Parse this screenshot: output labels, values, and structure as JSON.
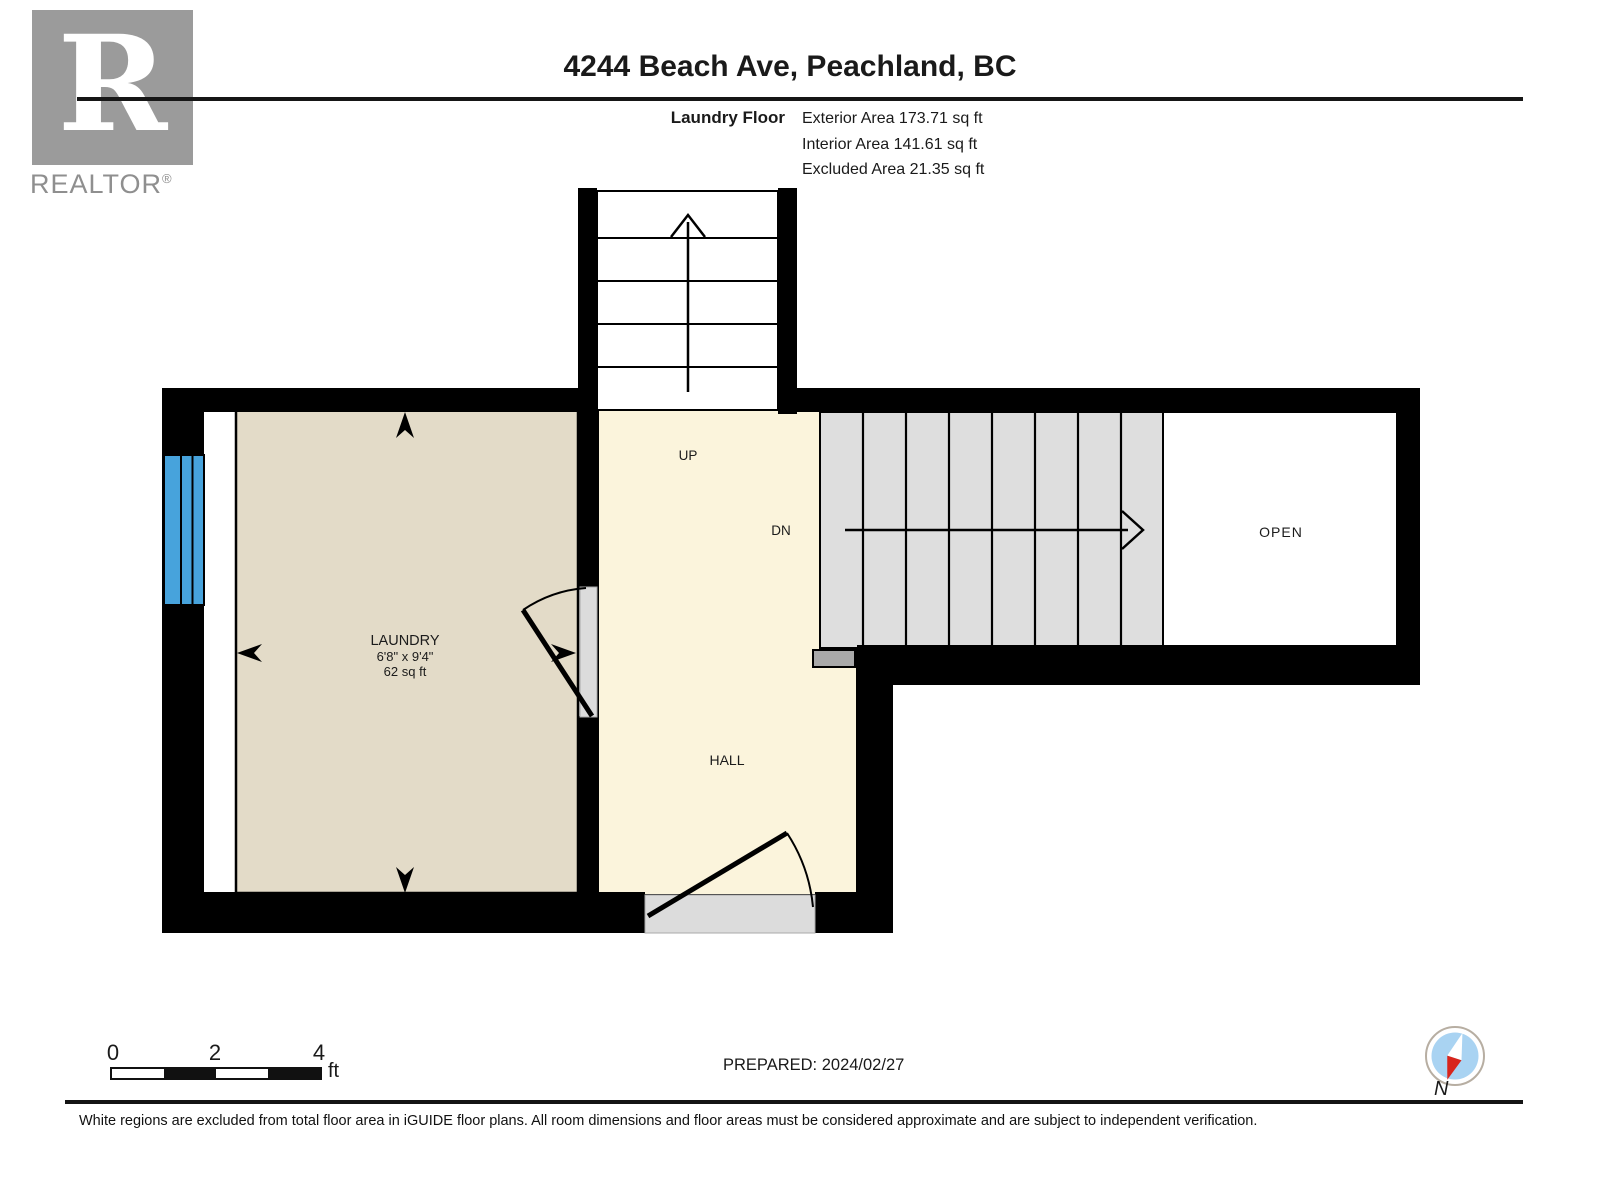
{
  "header": {
    "logo": {
      "letter": "R",
      "brand": "REALTOR",
      "registered": "®"
    },
    "title": "4244 Beach Ave, Peachland, BC",
    "floor_label": "Laundry Floor",
    "stats": [
      "Exterior Area 173.71 sq ft",
      "Interior Area 141.61 sq ft",
      "Excluded Area 21.35 sq ft"
    ]
  },
  "plan": {
    "rooms": {
      "laundry": {
        "name": "LAUNDRY",
        "dimensions": "6'8\" x 9'4\"",
        "area": "62 sq ft"
      },
      "hall": {
        "name": "HALL"
      },
      "open": {
        "name": "OPEN"
      },
      "stairs_up": {
        "label": "UP"
      },
      "stairs_down": {
        "label": "DN"
      }
    },
    "colors": {
      "wall": "#000000",
      "laundry": "#E3DBC8",
      "hall": "#FBF4DC",
      "stairs": "#DEDEDE",
      "threshold": "#DCDCDC",
      "marker": "#A9A9A9",
      "window": "#47A3DC"
    }
  },
  "footer": {
    "scale": {
      "ticks": [
        "0",
        "2",
        "4"
      ],
      "unit": "ft"
    },
    "prepared": "PREPARED: 2024/02/27",
    "compass_label": "N",
    "compass_colors": {
      "blue": "#A9D3F2",
      "red": "#D8251C"
    },
    "disclaimer": "White regions are excluded from total floor area in iGUIDE floor plans. All room dimensions and floor areas must be considered approximate and are subject to independent verification."
  }
}
